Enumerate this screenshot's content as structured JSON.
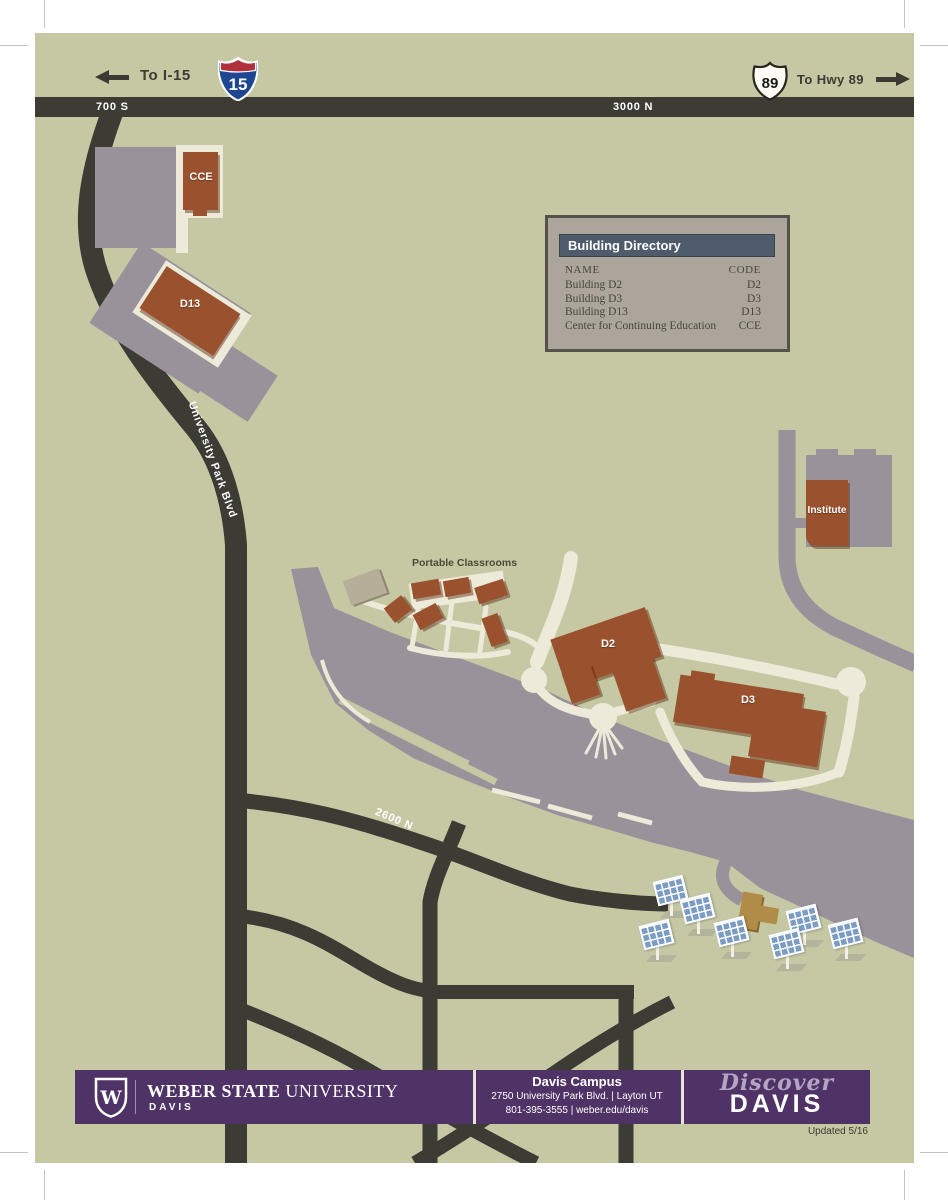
{
  "colors": {
    "background": "#c6c8a4",
    "road_dark": "#3c3c35",
    "parking_gray": "#9a929b",
    "walkway": "#edead9",
    "building_rust": "#9a512d",
    "building_tan": "#b7ae99",
    "building_ochre": "#b18c46",
    "solar_blue": "#7b9cc4",
    "footer_purple": "#4f3266",
    "directory_header": "#4d5b6a"
  },
  "signs": {
    "i15": {
      "label": "To I-15",
      "shield": "15"
    },
    "hwy89": {
      "label": "To Hwy 89",
      "shield": "89"
    }
  },
  "streets": {
    "s700": "700 S",
    "n3000": "3000 N",
    "n2600": "2600 N",
    "university_park_blvd": "University Park Blvd"
  },
  "map_labels": {
    "portable_classrooms": "Portable Classrooms"
  },
  "buildings": {
    "cce": "CCE",
    "d13": "D13",
    "d2": "D2",
    "d3": "D3",
    "institute": "Institute"
  },
  "directory": {
    "title": "Building Directory",
    "col_name": "NAME",
    "col_code": "CODE",
    "rows": [
      {
        "name": "Building D2",
        "code": "D2"
      },
      {
        "name": "Building D3",
        "code": "D3"
      },
      {
        "name": "Building D13",
        "code": "D13"
      },
      {
        "name": "Center for Continuing Education",
        "code": "CCE"
      }
    ]
  },
  "footer": {
    "logo_monogram": "W",
    "brand_bold": "WEBER STATE",
    "brand_light": " UNIVERSITY",
    "brand_sub": "DAVIS",
    "campus_title": "Davis Campus",
    "address": "2750 University Park Blvd.  |  Layton UT",
    "contact": "801-395-3555  |  weber.edu/davis",
    "discover_script": "Discover",
    "discover_caps": "DAVIS"
  },
  "updated": "Updated 5/16"
}
